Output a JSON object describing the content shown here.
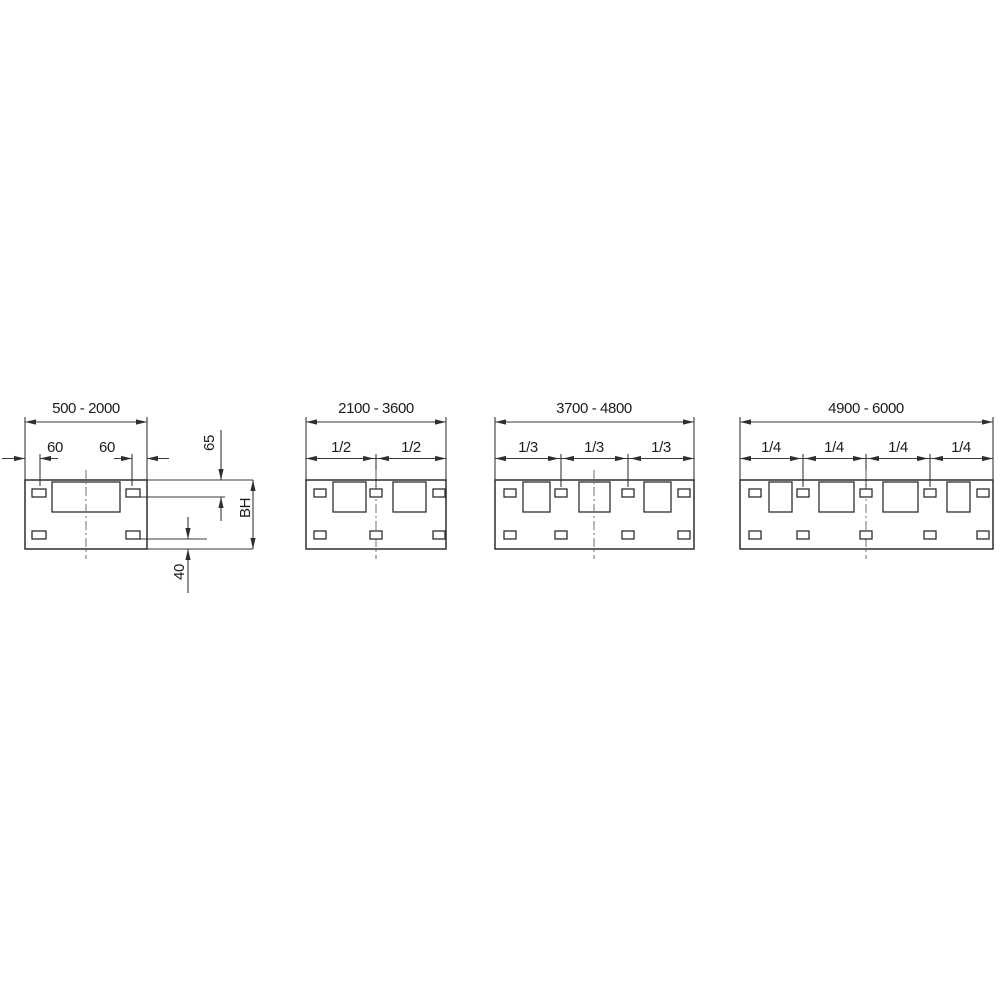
{
  "colors": {
    "background": "#ffffff",
    "line": "#2e2e2e",
    "centerline": "#6f6f6f",
    "text": "#1c1c1c"
  },
  "panels": [
    {
      "range": "500 - 2000",
      "offset_left": "60",
      "offset_right": "60",
      "inset_top": "65",
      "height_label": "BH",
      "inset_bottom": "40"
    },
    {
      "range": "2100 - 3600",
      "fractions": [
        "1/2",
        "1/2"
      ]
    },
    {
      "range": "3700 - 4800",
      "fractions": [
        "1/3",
        "1/3",
        "1/3"
      ]
    },
    {
      "range": "4900 - 6000",
      "fractions": [
        "1/4",
        "1/4",
        "1/4",
        "1/4"
      ]
    }
  ]
}
